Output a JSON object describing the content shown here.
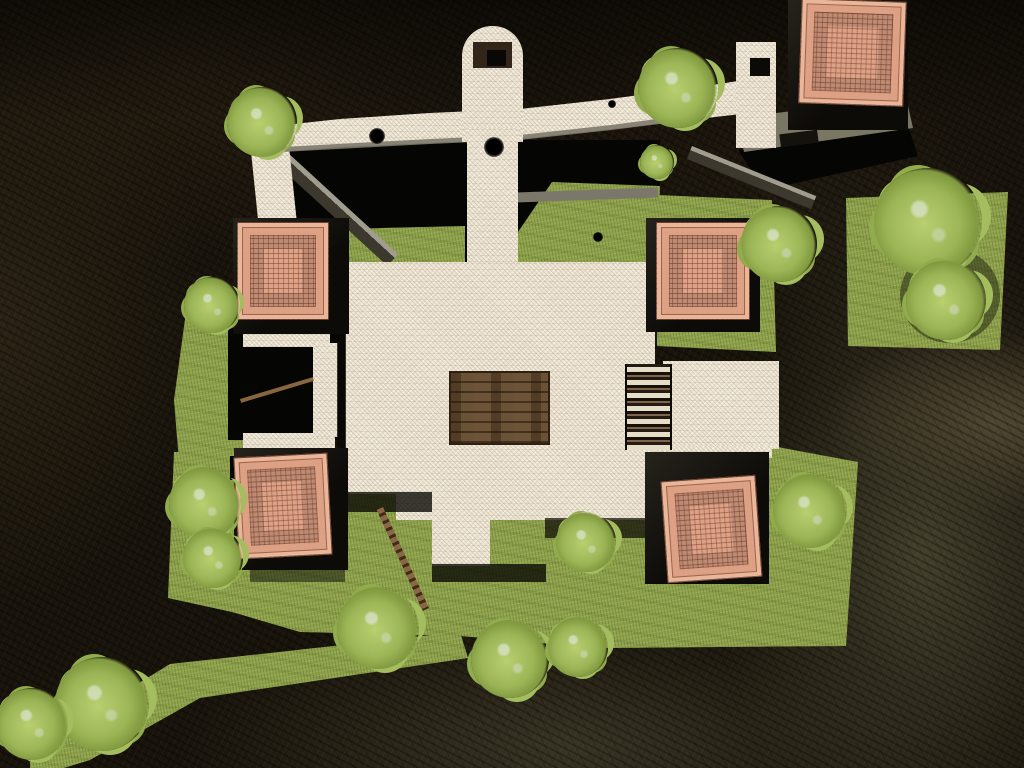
{
  "meta": {
    "description": "Top-down aerial view of a 3D game map: white-stone walled courtyard with terracotta tiled tower roofs, wooden platforms and ladders, grass fields with trees, surrounded by dark rock cliffs"
  },
  "palette": {
    "rock_dark": "#18130b",
    "rock_moss": "#43402c",
    "grass": "#8fa24d",
    "tree_green": "#a3bd5f",
    "stone_white": "#ebe3d1",
    "roof_tile": "#dca287",
    "roof_line": "#7a3e28",
    "tower_wall_dark": "#15120d",
    "wood_brown": "#6d5338",
    "concrete_grey": "#7a7664",
    "shadow_black": "#050503"
  },
  "scene": {
    "shapes": [
      {
        "name": "courtyard-shadow-gap-top",
        "cls": "gap",
        "points": [
          [
            278,
            152
          ],
          [
            470,
            140
          ],
          [
            660,
            140
          ],
          [
            660,
            264
          ],
          [
            300,
            264
          ],
          [
            284,
            214
          ]
        ]
      },
      {
        "name": "walkway-shadow-topright",
        "cls": "gap",
        "points": [
          [
            738,
            150
          ],
          [
            908,
            126
          ],
          [
            918,
            156
          ],
          [
            764,
            190
          ]
        ]
      },
      {
        "name": "grass-gap-left",
        "cls": "tex-grass",
        "points": [
          [
            302,
            230
          ],
          [
            465,
            226
          ],
          [
            465,
            266
          ],
          [
            340,
            268
          ],
          [
            303,
            262
          ]
        ]
      },
      {
        "name": "grass-gap-right",
        "cls": "tex-grass",
        "points": [
          [
            518,
            232
          ],
          [
            552,
            182
          ],
          [
            660,
            186
          ],
          [
            657,
            264
          ],
          [
            518,
            264
          ]
        ]
      },
      {
        "name": "grass-right-of-plaza",
        "cls": "tex-grass",
        "points": [
          [
            657,
            195
          ],
          [
            772,
            200
          ],
          [
            776,
            352
          ],
          [
            657,
            346
          ]
        ]
      },
      {
        "name": "grass-far-right-terrace",
        "cls": "tex-grass",
        "points": [
          [
            846,
            198
          ],
          [
            1008,
            192
          ],
          [
            1000,
            350
          ],
          [
            848,
            346
          ]
        ]
      },
      {
        "name": "grass-main-field",
        "cls": "tex-grass",
        "points": [
          [
            174,
            452
          ],
          [
            772,
            446
          ],
          [
            858,
            462
          ],
          [
            846,
            646
          ],
          [
            600,
            648
          ],
          [
            460,
            636
          ],
          [
            300,
            632
          ],
          [
            232,
            612
          ],
          [
            168,
            598
          ]
        ]
      },
      {
        "name": "grass-diagonal-band",
        "cls": "tex-grass",
        "points": [
          [
            30,
            750
          ],
          [
            170,
            664
          ],
          [
            460,
            632
          ],
          [
            468,
            658
          ],
          [
            200,
            698
          ],
          [
            90,
            760
          ],
          [
            64,
            768
          ],
          [
            30,
            768
          ]
        ]
      },
      {
        "name": "grass-left-ledge",
        "cls": "tex-grass",
        "points": [
          [
            186,
            312
          ],
          [
            245,
            316
          ],
          [
            245,
            478
          ],
          [
            180,
            474
          ],
          [
            174,
            400
          ]
        ]
      },
      {
        "name": "wall-edge-beam-left",
        "x1": 287,
        "y1": 152,
        "x2": 398,
        "y2": 254,
        "w": 16,
        "cls": "wallbeam"
      },
      {
        "name": "wall-edge-strip-right",
        "x": 516,
        "y": 190,
        "w": 142,
        "h": 10,
        "rot": -2,
        "fill": "#7b776a"
      },
      {
        "name": "concrete-walkway-topright",
        "cls": "",
        "points": [
          [
            736,
            118
          ],
          [
            906,
            97
          ],
          [
            913,
            128
          ],
          [
            744,
            152
          ]
        ],
        "fill": "#7a7664"
      },
      {
        "name": "walkway-window-slot",
        "x": 780,
        "y": 132,
        "w": 38,
        "h": 13,
        "rot": -7,
        "fill": "#14120c"
      },
      {
        "name": "wall-descending-beam-topright",
        "x1": 692,
        "y1": 146,
        "x2": 816,
        "y2": 196,
        "w": 14,
        "cls": "wallbeam"
      },
      {
        "name": "porch-cave-left",
        "cls": "gap",
        "x": 228,
        "y": 318,
        "w": 120,
        "h": 122
      },
      {
        "name": "porch-cave-left-lower",
        "cls": "gap",
        "x": 230,
        "y": 456,
        "w": 110,
        "h": 24
      },
      {
        "name": "rampart-left-leg",
        "cls": "tex-stone",
        "points": [
          [
            248,
            122
          ],
          [
            286,
            117
          ],
          [
            297,
            224
          ],
          [
            259,
            229
          ]
        ]
      },
      {
        "name": "rampart-curved-wall",
        "cls": "tex-stone",
        "points": [
          [
            276,
            126
          ],
          [
            340,
            119
          ],
          [
            430,
            113
          ],
          [
            520,
            109
          ],
          [
            610,
            99
          ],
          [
            700,
            87
          ],
          [
            738,
            81
          ],
          [
            741,
            114
          ],
          [
            706,
            118
          ],
          [
            612,
            129
          ],
          [
            520,
            139
          ],
          [
            430,
            143
          ],
          [
            340,
            147
          ],
          [
            280,
            152
          ]
        ]
      },
      {
        "name": "rampart-grey-lip",
        "points": [
          [
            282,
            147
          ],
          [
            430,
            139
          ],
          [
            520,
            135
          ],
          [
            611,
            125
          ],
          [
            705,
            113
          ],
          [
            706,
            118
          ],
          [
            612,
            130
          ],
          [
            520,
            140
          ],
          [
            430,
            144
          ],
          [
            282,
            152
          ]
        ],
        "fill": "rgba(125,121,108,0.9)"
      },
      {
        "name": "rampart-corner-wall",
        "cls": "tex-stone",
        "x": 736,
        "y": 42,
        "w": 40,
        "h": 106
      },
      {
        "name": "rampart-corner-window",
        "x": 750,
        "y": 58,
        "w": 20,
        "h": 18,
        "fill": "#0c0a06"
      },
      {
        "name": "bell-tower-arch",
        "cls": "tex-stone",
        "x": 462,
        "y": 26,
        "w": 61,
        "h": 116,
        "radius": "30px 30px 0 0"
      },
      {
        "name": "bell-tower-wood-landing",
        "x": 473,
        "y": 42,
        "w": 39,
        "h": 26,
        "fill": "#33251a"
      },
      {
        "name": "bell-tower-hatch",
        "x": 487,
        "y": 50,
        "w": 19,
        "h": 16,
        "fill": "#0a0806"
      },
      {
        "name": "bell-tower-bridge-strip",
        "cls": "tex-stone",
        "x": 467,
        "y": 128,
        "w": 51,
        "h": 140
      },
      {
        "name": "plaza-main",
        "cls": "tex-stone",
        "points": [
          [
            345,
            262
          ],
          [
            655,
            262
          ],
          [
            655,
            520
          ],
          [
            490,
            520
          ],
          [
            490,
            566
          ],
          [
            432,
            566
          ],
          [
            432,
            520
          ],
          [
            396,
            520
          ],
          [
            396,
            494
          ],
          [
            345,
            494
          ]
        ]
      },
      {
        "name": "porch-beam-upper",
        "cls": "tex-stone",
        "x": 243,
        "y": 323,
        "w": 87,
        "h": 24
      },
      {
        "name": "porch-beam-lower",
        "cls": "tex-stone",
        "x": 243,
        "y": 433,
        "w": 92,
        "h": 24
      },
      {
        "name": "porch-pillar",
        "cls": "tex-stone",
        "x": 313,
        "y": 343,
        "w": 25,
        "h": 94
      },
      {
        "name": "east-platform",
        "cls": "tex-stone",
        "x": 663,
        "y": 361,
        "w": 116,
        "h": 88
      },
      {
        "name": "east-wall-strip",
        "cls": "tex-stone",
        "x": 652,
        "y": 313,
        "w": 88,
        "h": 17
      },
      {
        "name": "southeast-tower-ledge",
        "cls": "tex-stone",
        "x": 652,
        "y": 446,
        "w": 120,
        "h": 12
      },
      {
        "name": "plaza-left-edge-shadow",
        "x": 337,
        "y": 262,
        "w": 9,
        "h": 232,
        "fill": "rgba(10,8,5,0.8)"
      },
      {
        "name": "plaza-south-shadow-west",
        "x": 345,
        "y": 492,
        "w": 87,
        "h": 20,
        "fill": "rgba(8,6,3,0.78)"
      },
      {
        "name": "plaza-tongue-shadow",
        "x": 432,
        "y": 564,
        "w": 114,
        "h": 18,
        "fill": "rgba(8,6,3,0.78)"
      },
      {
        "name": "plaza-south-shadow-east",
        "x": 545,
        "y": 518,
        "w": 110,
        "h": 20,
        "fill": "rgba(8,6,3,0.7)"
      },
      {
        "name": "southwest-tower-ground-shadow",
        "x": 250,
        "y": 560,
        "w": 95,
        "h": 22,
        "fill": "rgba(10,8,5,0.5)"
      },
      {
        "name": "big-tree-ground-shadow",
        "x": 900,
        "y": 248,
        "w": 100,
        "h": 95,
        "radius": "50%",
        "fill": "rgba(15,15,8,0.45)"
      },
      {
        "name": "central-wood-platform",
        "cls": "tex-wood",
        "x": 449,
        "y": 371,
        "w": 97,
        "h": 70
      },
      {
        "name": "slatted-bridge",
        "cls": "tex-slats",
        "x": 625,
        "y": 364,
        "w": 43,
        "h": 86
      },
      {
        "name": "wood-ladder-southwest",
        "x1": 383,
        "y1": 507,
        "x2": 429,
        "y2": 608,
        "w": 7,
        "cls": "ladder"
      },
      {
        "name": "wood-beam-porch",
        "x1": 240,
        "y1": 399,
        "x2": 313,
        "y2": 377,
        "w": 4,
        "fill": "#86653f"
      }
    ],
    "towers": [
      {
        "name": "tower-northeast",
        "base": {
          "x": 788,
          "y": 0,
          "w": 120,
          "h": 130
        },
        "roof": {
          "x": 800,
          "y": 0,
          "w": 103,
          "h": 103,
          "rot": 2
        }
      },
      {
        "name": "tower-west",
        "base": {
          "x": 233,
          "y": 218,
          "w": 116,
          "h": 116
        },
        "roof": {
          "x": 237,
          "y": 222,
          "w": 90,
          "h": 96,
          "rot": 0
        }
      },
      {
        "name": "tower-east",
        "base": {
          "x": 646,
          "y": 218,
          "w": 114,
          "h": 114
        },
        "roof": {
          "x": 656,
          "y": 222,
          "w": 92,
          "h": 96,
          "rot": 0
        }
      },
      {
        "name": "tower-southwest",
        "base": {
          "x": 234,
          "y": 448,
          "w": 114,
          "h": 122
        },
        "roof": {
          "x": 236,
          "y": 455,
          "w": 92,
          "h": 100,
          "rot": -3
        }
      },
      {
        "name": "tower-southeast",
        "base": {
          "x": 645,
          "y": 452,
          "w": 124,
          "h": 132
        },
        "roof": {
          "x": 664,
          "y": 478,
          "w": 93,
          "h": 100,
          "rot": -4
        }
      }
    ],
    "marks": [
      {
        "name": "scorch-mark-rampart",
        "cx": 377,
        "cy": 136,
        "r": 8
      },
      {
        "name": "scorch-mark-bridge-strip",
        "cx": 494,
        "cy": 147,
        "r": 10
      },
      {
        "name": "scorch-mark-rampart-east",
        "cx": 612,
        "cy": 104,
        "r": 4
      },
      {
        "name": "scorch-mark-grass",
        "cx": 598,
        "cy": 237,
        "r": 5
      }
    ],
    "trees": [
      {
        "name": "tree-rampart-west",
        "cx": 262,
        "cy": 122,
        "r": 35
      },
      {
        "name": "tree-rampart-east",
        "cx": 678,
        "cy": 88,
        "r": 40
      },
      {
        "name": "tree-small-below-rampart",
        "cx": 657,
        "cy": 162,
        "r": 17
      },
      {
        "name": "tree-east-wall-corner",
        "cx": 779,
        "cy": 244,
        "r": 38
      },
      {
        "name": "tree-far-right-large",
        "cx": 928,
        "cy": 222,
        "r": 54
      },
      {
        "name": "tree-far-right-lower",
        "cx": 946,
        "cy": 300,
        "r": 40
      },
      {
        "name": "tree-left-ledge",
        "cx": 212,
        "cy": 305,
        "r": 28
      },
      {
        "name": "tree-left-mid-upper",
        "cx": 205,
        "cy": 503,
        "r": 36
      },
      {
        "name": "tree-left-mid-lower",
        "cx": 213,
        "cy": 558,
        "r": 30
      },
      {
        "name": "tree-bottom-left-large",
        "cx": 102,
        "cy": 704,
        "r": 47
      },
      {
        "name": "tree-bottom-left-corner",
        "cx": 32,
        "cy": 724,
        "r": 36
      },
      {
        "name": "tree-bottom-center-west",
        "cx": 378,
        "cy": 628,
        "r": 41
      },
      {
        "name": "tree-bottom-center",
        "cx": 510,
        "cy": 659,
        "r": 39
      },
      {
        "name": "tree-bottom-center-east",
        "cx": 578,
        "cy": 647,
        "r": 30
      },
      {
        "name": "tree-south-of-plaza",
        "cx": 586,
        "cy": 542,
        "r": 30
      },
      {
        "name": "tree-southeast-field",
        "cx": 810,
        "cy": 511,
        "r": 37
      }
    ]
  }
}
